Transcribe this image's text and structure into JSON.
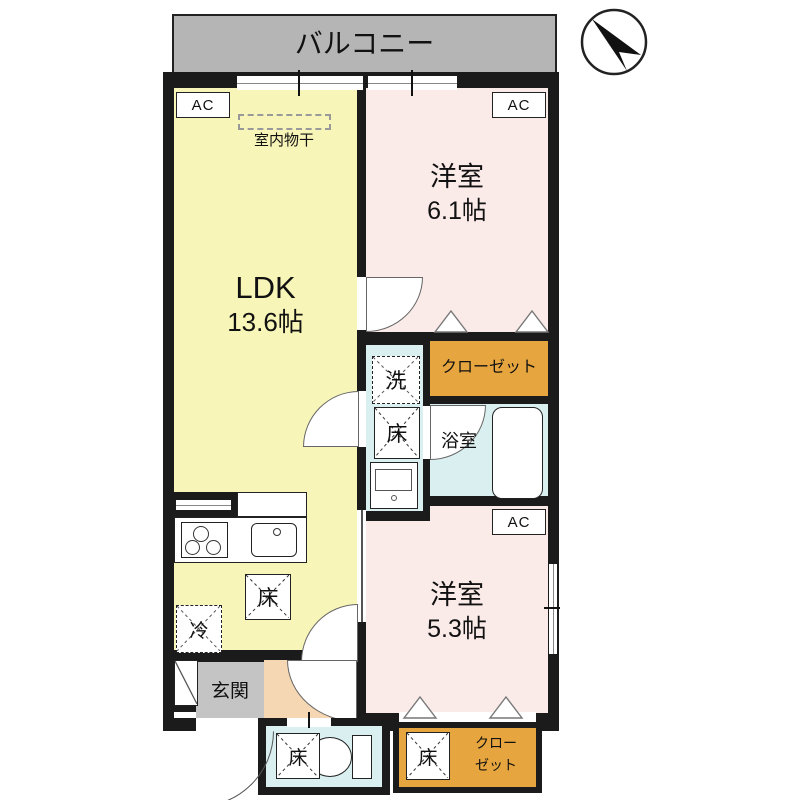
{
  "balcony": {
    "label": "バルコニー"
  },
  "compass": {
    "name": "north-arrow"
  },
  "rooms": {
    "ldk": {
      "name": "LDK",
      "size": "13.6帖"
    },
    "bedroom1": {
      "name": "洋室",
      "size": "6.1帖"
    },
    "bedroom2": {
      "name": "洋室",
      "size": "5.3帖"
    },
    "bath": {
      "label": "浴室"
    },
    "genkan": {
      "label": "玄関"
    },
    "closet_top": {
      "label": "クローゼット"
    },
    "closet_bottom": {
      "line1": "クロー",
      "line2": "ゼット"
    }
  },
  "labels": {
    "ac": "AC",
    "floor": "床",
    "washer": "洗",
    "fridge": "冷",
    "indoor_drying": "室内物干"
  },
  "colors": {
    "wall": "#1b1b1b",
    "balcony": "#b5b5b5",
    "ldk": "#f8f5b8",
    "bedroom": "#faeae8",
    "wet": "#daf0f0",
    "closet": "#e6a53e",
    "corridor": "#f6d7b3",
    "genkan": "#c4c4c4"
  }
}
